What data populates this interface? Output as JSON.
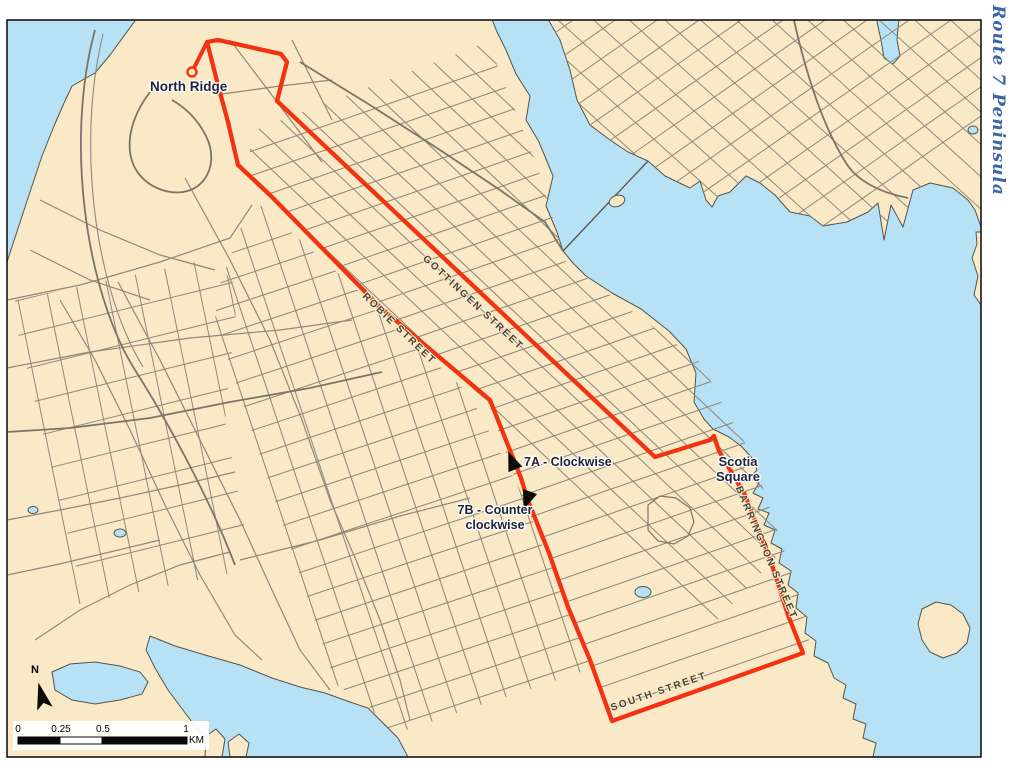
{
  "map": {
    "region_title": "Route 7 Peninsula",
    "colors": {
      "water": "#b7e2f6",
      "land": "#f9e9c6",
      "coast": "#55534a",
      "street": "#8f897b",
      "major_street": "#7b7566",
      "route": "#f23211",
      "label_dark": "#1d2438",
      "street_label": "#45423a",
      "title_blue": "#3c66a9"
    },
    "labels": {
      "terminus": "North Ridge",
      "direction_a": "7A - Clockwise",
      "direction_b_line1": "7B - Counter",
      "direction_b_line2": "clockwise",
      "scotia_line1": "Scotia",
      "scotia_line2": "Square"
    },
    "street_labels": [
      {
        "text": "GOTTINGEN STREET",
        "x": 473,
        "y": 303,
        "angle": 43
      },
      {
        "text": "ROBIE STREET",
        "x": 399,
        "y": 329,
        "angle": 44
      },
      {
        "text": "BARRINGTON STREET",
        "x": 766,
        "y": 553,
        "angle": 67
      },
      {
        "text": "SOUTH STREET",
        "x": 659,
        "y": 692,
        "angle": -19
      }
    ],
    "route": {
      "name": "Route 7",
      "loop_points": [
        [
          207,
          42
        ],
        [
          218,
          40
        ],
        [
          281,
          54
        ],
        [
          287,
          62
        ],
        [
          277,
          101
        ],
        [
          655,
          457
        ],
        [
          710,
          440
        ],
        [
          714,
          436
        ],
        [
          719,
          451
        ],
        [
          745,
          495
        ],
        [
          769,
          556
        ],
        [
          788,
          615
        ],
        [
          803,
          653
        ],
        [
          612,
          721
        ],
        [
          590,
          660
        ],
        [
          568,
          607
        ],
        [
          549,
          553
        ],
        [
          527,
          498
        ],
        [
          521,
          478
        ],
        [
          490,
          400
        ],
        [
          380,
          307
        ],
        [
          270,
          195
        ],
        [
          238,
          165
        ],
        [
          228,
          122
        ],
        [
          218,
          85
        ]
      ],
      "spur_points": [
        [
          192,
          72
        ],
        [
          207,
          42
        ]
      ],
      "terminus_point": [
        192,
        72
      ],
      "arrow_a": {
        "x": 512,
        "y": 461,
        "angle": -22
      },
      "arrow_b": {
        "x": 527,
        "y": 500,
        "angle": 20
      }
    },
    "scale_bar": {
      "tick_labels": [
        "0",
        "0.25",
        "0.5",
        "1"
      ],
      "unit": "KM"
    },
    "north_label": "N"
  }
}
